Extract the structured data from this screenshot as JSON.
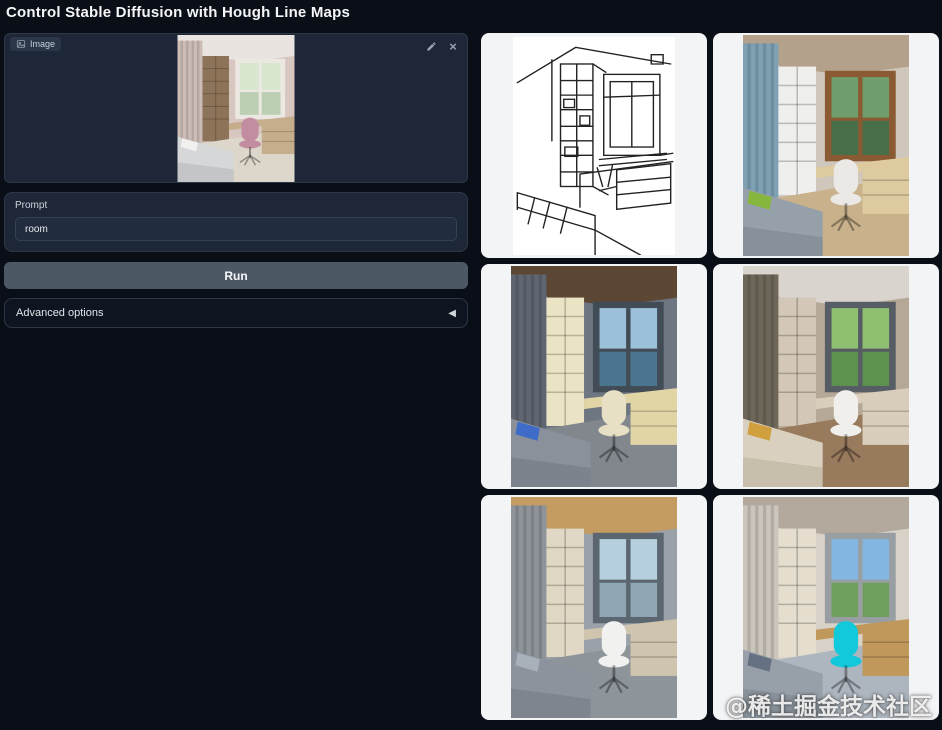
{
  "header": {
    "title": "Control Stable Diffusion with Hough Line Maps"
  },
  "upload": {
    "badge_label": "Image",
    "badge_icon": "image-icon",
    "edit_icon": "pencil-icon",
    "clear_icon": "close-icon",
    "clear_glyph": "×",
    "preview_alt": "uploaded bedroom photo with wooden bookshelf, window, desk and pink chair",
    "palette": {
      "wall": "#d8c6c1",
      "ceiling": "#e9e4df",
      "curtain": "#cdbcb6",
      "shelf": "#8d7458",
      "frame": "#ebe8e2",
      "view": "#d9e6cf",
      "view2": "#bccfb2",
      "desk": "#c6ae8d",
      "chair": "#c28da0",
      "bed": "#d5d7d8",
      "bedDark": "#c3c5c6",
      "pillow": "#f0f0ee",
      "floor": "#dcd6cb"
    }
  },
  "prompt": {
    "label": "Prompt",
    "value": "room"
  },
  "actions": {
    "run_label": "Run"
  },
  "advanced": {
    "label": "Advanced options",
    "collapse_glyph": "◀"
  },
  "gallery": {
    "items": [
      {
        "kind": "sketch",
        "alt": "Hough line map black-and-white sketch of the bedroom"
      },
      {
        "kind": "photo",
        "alt": "generated bedroom with blue curtains, white shelf and green pillow",
        "palette": {
          "wall": "#cfc7bb",
          "ceiling": "#b4a18b",
          "curtain": "#7ea2b4",
          "shelf": "#eff0ee",
          "frame": "#8a5a33",
          "view": "#6f9d6b",
          "view2": "#47704a",
          "desk": "#ddca9f",
          "chair": "#eae9e6",
          "bed": "#96a0aa",
          "bedDark": "#87919b",
          "pillow": "#86b63e",
          "floor": "#c9b28b"
        }
      },
      {
        "kind": "photo",
        "alt": "generated bedroom with dark wood ceiling, cream shelf and sea view",
        "palette": {
          "wall": "#6e7681",
          "ceiling": "#5c4634",
          "curtain": "#5f6671",
          "shelf": "#ebe4c4",
          "frame": "#424c57",
          "view": "#9cc0da",
          "view2": "#4a768f",
          "desk": "#e1d5a6",
          "chair": "#e7e0c4",
          "bed": "#8a919b",
          "bedDark": "#7c838d",
          "pillow": "#3e6cc8",
          "floor": "#82878e"
        }
      },
      {
        "kind": "photo",
        "alt": "generated beige bedroom with dark curtains and garden view",
        "palette": {
          "wall": "#b5a896",
          "ceiling": "#d9d4cd",
          "curtain": "#6e6659",
          "shelf": "#d3c8b7",
          "frame": "#575d64",
          "view": "#8fbf70",
          "view2": "#5d924e",
          "desk": "#d9cdbb",
          "chair": "#f0efeb",
          "bed": "#d9d0bf",
          "bedDark": "#c8beac",
          "pillow": "#d0a03e",
          "floor": "#987a5d"
        }
      },
      {
        "kind": "photo",
        "alt": "generated gray bedroom with wooden ceiling and mountain view",
        "palette": {
          "wall": "#9ba1a8",
          "ceiling": "#c49b60",
          "curtain": "#8f949a",
          "shelf": "#e0d8c4",
          "frame": "#5c6671",
          "view": "#b5cfdf",
          "view2": "#8fa7b5",
          "desk": "#cfc4ae",
          "chair": "#f1f1ef",
          "bed": "#8c939c",
          "bedDark": "#7e858e",
          "pillow": "#a8b0b9",
          "floor": "#8d949a"
        }
      },
      {
        "kind": "photo",
        "alt": "generated bright bedroom with concrete ceiling and cyan chair",
        "palette": {
          "wall": "#d7d1c8",
          "ceiling": "#b2a99c",
          "curtain": "#cbc5bb",
          "shelf": "#e5dece",
          "frame": "#989ea1",
          "view": "#83b7e2",
          "view2": "#6e9f5d",
          "desk": "#c1985b",
          "chair": "#12c8db",
          "bed": "#97a0a9",
          "bedDark": "#89929b",
          "pillow": "#657082",
          "floor": "#adb5be"
        }
      }
    ]
  },
  "watermark": {
    "text": "@稀土掘金技术社区"
  },
  "theme": {
    "page_bg": "#0a0e16",
    "panel_bg": "#1d2737",
    "panel_border": "#2c3848",
    "input_bg": "#212d3f",
    "button_bg": "#4d5865",
    "accordion_bg": "#0e1420",
    "cell_bg": "#f3f4f6",
    "text": "#e7eaee",
    "muted": "#9ca3af"
  }
}
